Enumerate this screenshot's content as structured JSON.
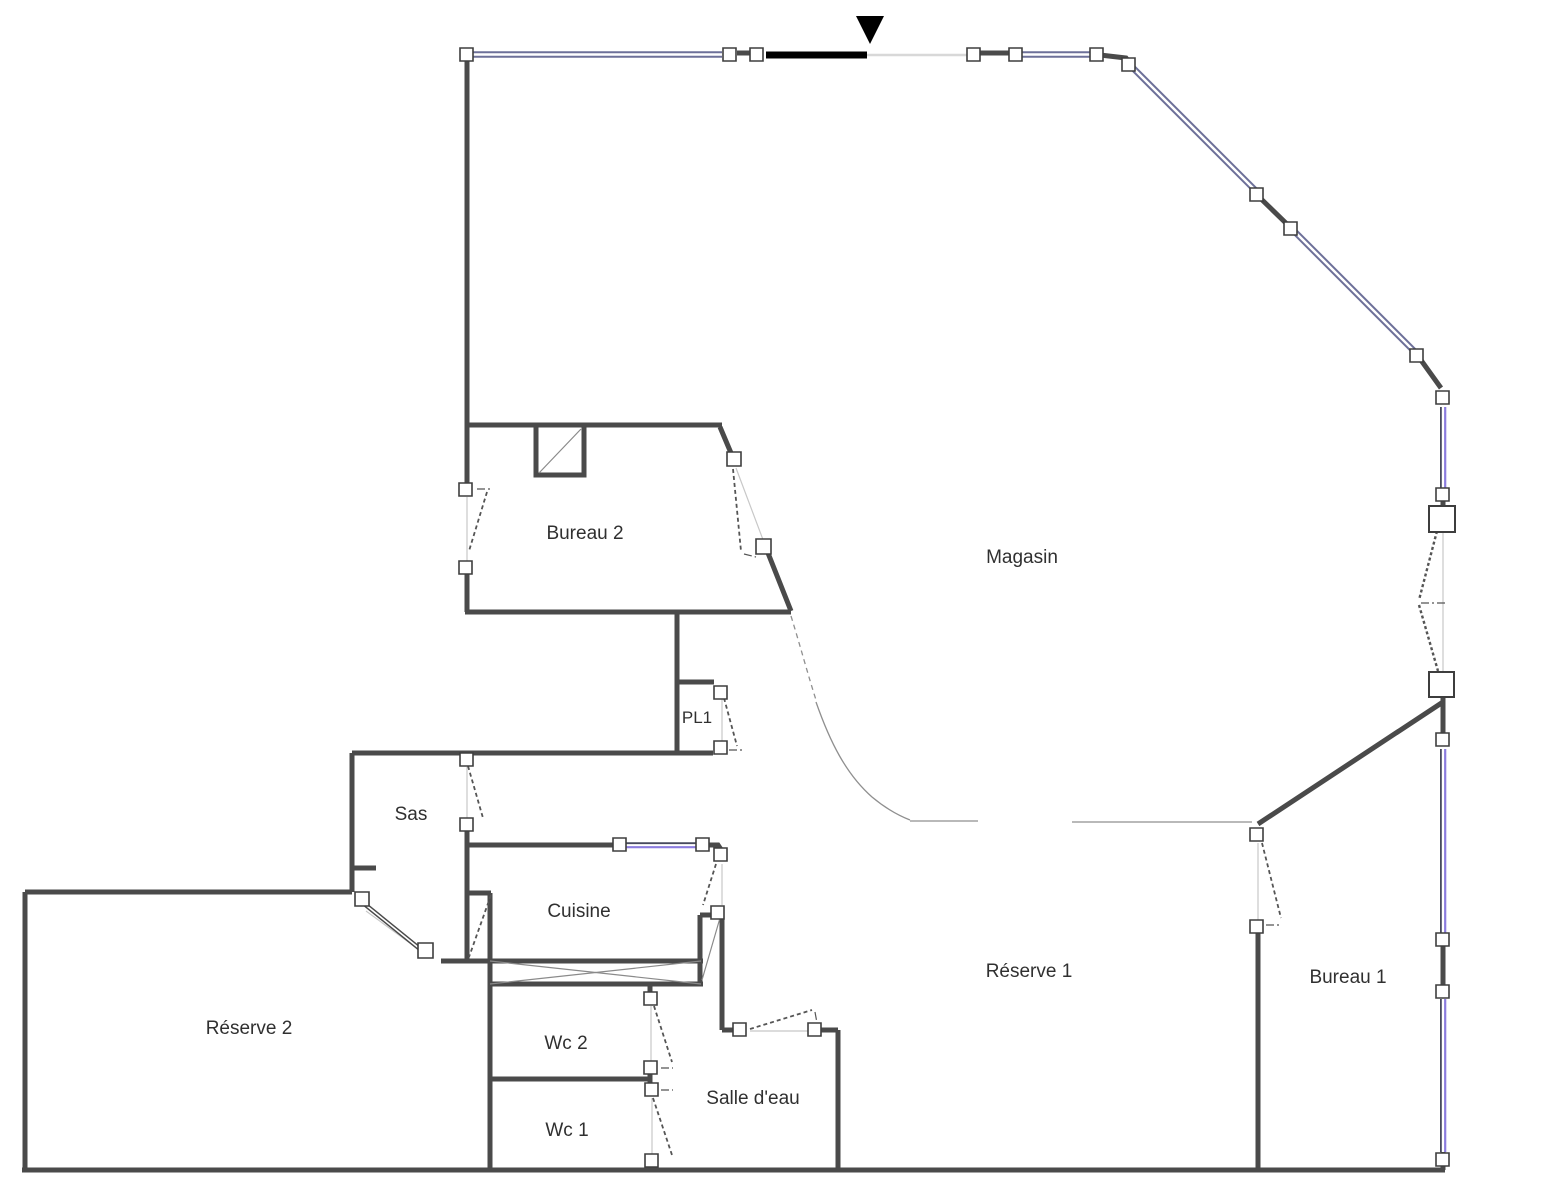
{
  "document": {
    "type": "floor-plan",
    "language": "fr"
  },
  "colors": {
    "background": "#ffffff",
    "wall": "#4a4a4a",
    "window_slate": "#6d7099",
    "window_dark": "#474a5e",
    "window_purple": "#8b7cdf",
    "door_leaf": "#555555",
    "thin_line": "#c8c8c8",
    "boundary": "#8f8f8f",
    "opening": "#d8d8d8",
    "entrance": "#000000",
    "label": "#303030",
    "hinge_fill": "#ffffff",
    "hinge_stroke": "#3e3e3e"
  },
  "rooms": [
    {
      "id": "bureau2",
      "label": "Bureau 2"
    },
    {
      "id": "magasin",
      "label": "Magasin"
    },
    {
      "id": "pl1",
      "label": "PL1"
    },
    {
      "id": "sas",
      "label": "Sas"
    },
    {
      "id": "cuisine",
      "label": "Cuisine"
    },
    {
      "id": "reserve2",
      "label": "Réserve 2"
    },
    {
      "id": "wc2",
      "label": "Wc 2"
    },
    {
      "id": "wc1",
      "label": "Wc 1"
    },
    {
      "id": "salledeau",
      "label": "Salle d'eau"
    },
    {
      "id": "reserve1",
      "label": "Réserve 1"
    },
    {
      "id": "bureau1",
      "label": "Bureau 1"
    }
  ],
  "symbols": {
    "entrance_marker": "entrance-arrow",
    "window_style": "double-line",
    "door_style": "dashed-leaf"
  }
}
